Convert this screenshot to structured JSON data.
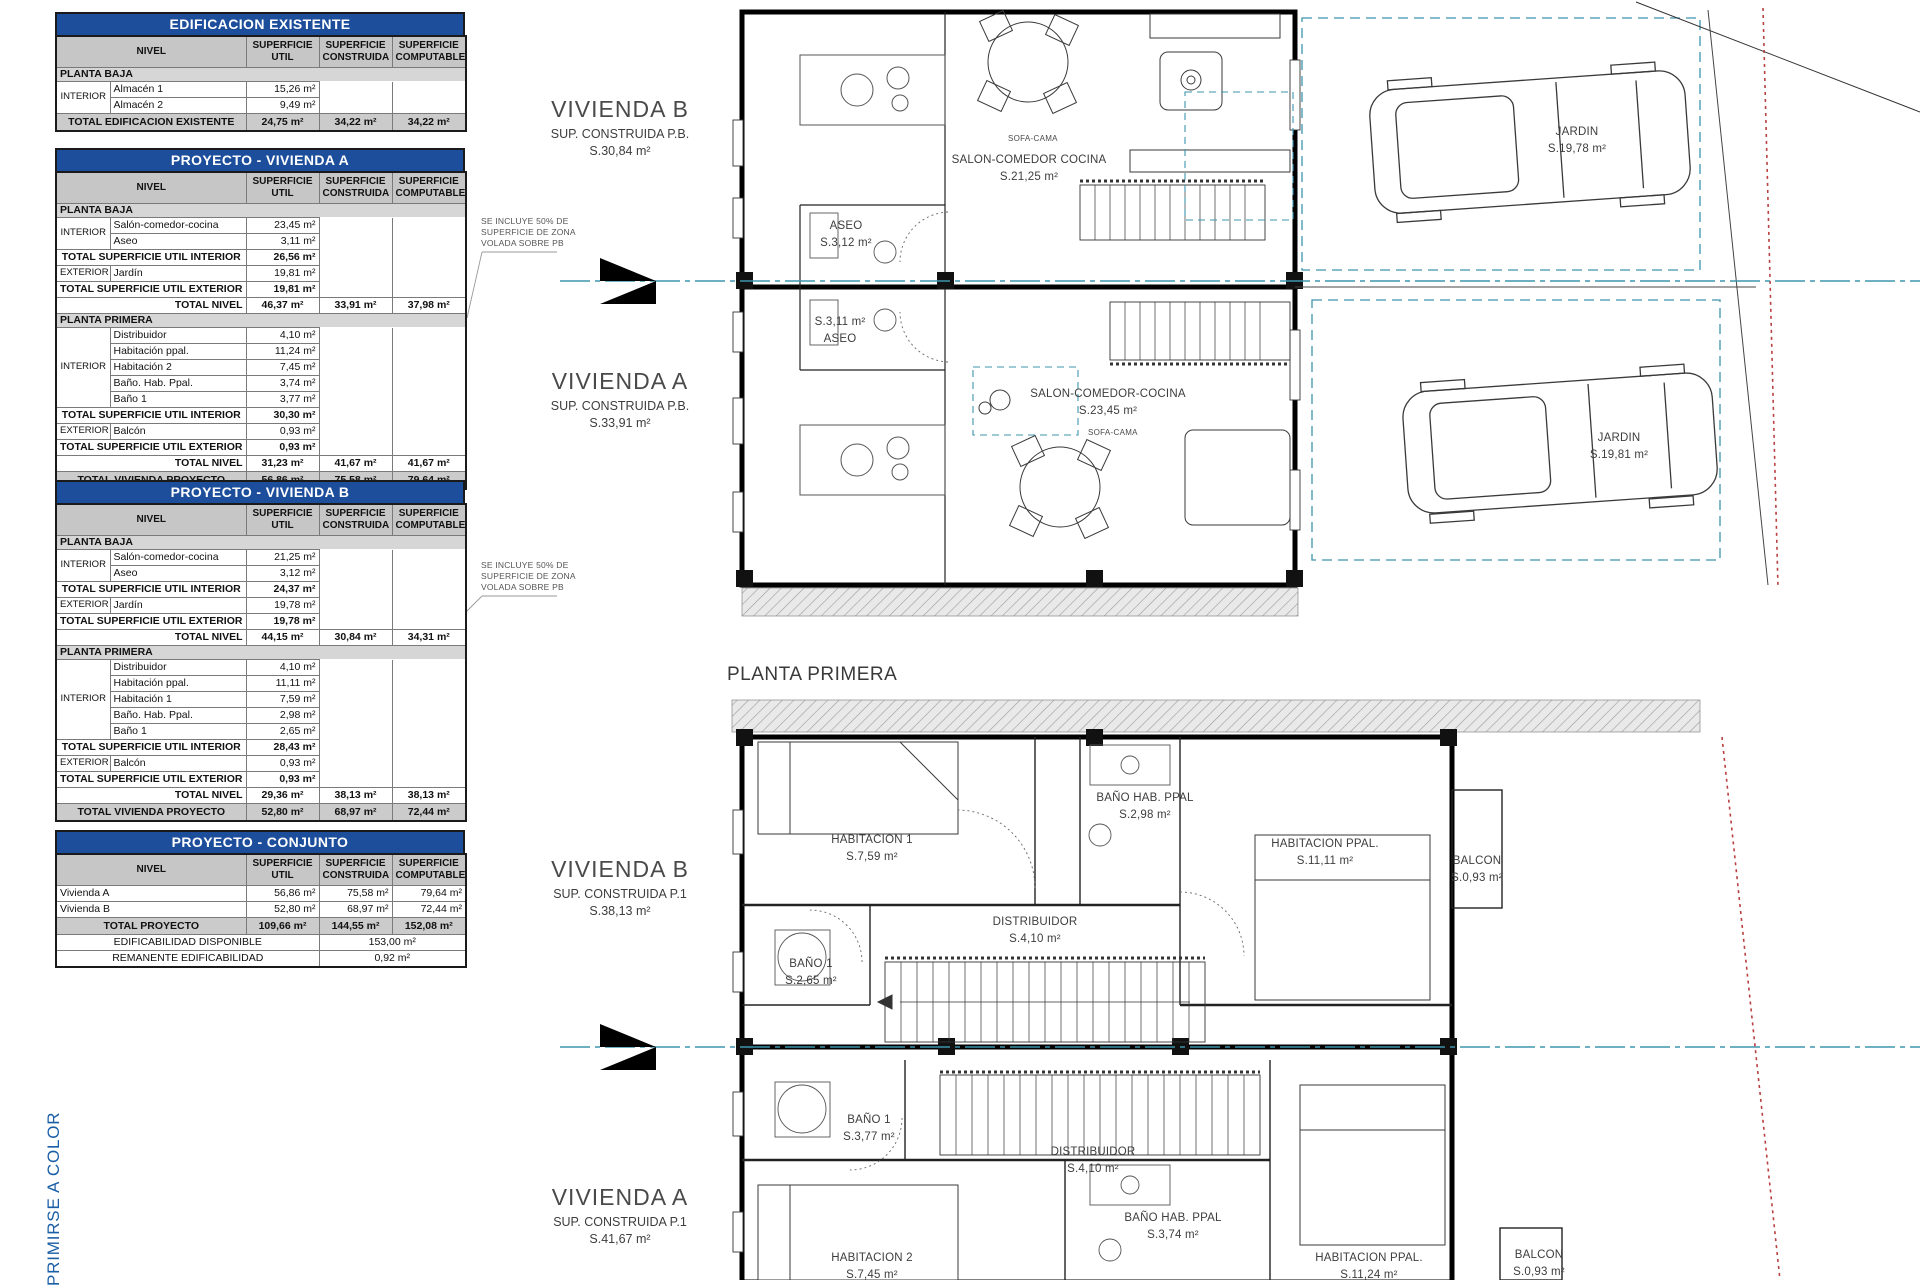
{
  "table_headers": {
    "nivel": "NIVEL",
    "util": "SUPERFICIE\nUTIL",
    "cons": "SUPERFICIE\nCONSTRUIDA",
    "comp": "SUPERFICIE\nCOMPUTABLE"
  },
  "tables": [
    {
      "title": "EDIFICACION EXISTENTE",
      "rows": [
        {
          "t": "sec",
          "label": "PLANTA BAJA"
        },
        {
          "t": "item",
          "group": "INTERIOR",
          "gspan": 2,
          "name": "Almacén 1",
          "util": "15,26 m²"
        },
        {
          "t": "item",
          "name": "Almacén 2",
          "util": "9,49 m²"
        },
        {
          "t": "grand",
          "label": "TOTAL EDIFICACION EXISTENTE",
          "util": "24,75 m²",
          "cons": "34,22 m²",
          "comp": "34,22 m²"
        }
      ]
    },
    {
      "title": "PROYECTO - VIVIENDA A",
      "rows": [
        {
          "t": "sec",
          "label": "PLANTA BAJA"
        },
        {
          "t": "item",
          "group": "INTERIOR",
          "gspan": 2,
          "name": "Salón-comedor-cocina",
          "util": "23,45 m²"
        },
        {
          "t": "item",
          "name": "Aseo",
          "util": "3,11 m²"
        },
        {
          "t": "sub",
          "label": "TOTAL SUPERFICIE UTIL INTERIOR",
          "util": "26,56 m²"
        },
        {
          "t": "item",
          "group": "EXTERIOR",
          "gspan": 1,
          "name": "Jardín",
          "util": "19,81 m²"
        },
        {
          "t": "sub",
          "label": "TOTAL SUPERFICIE UTIL EXTERIOR",
          "util": "19,81 m²"
        },
        {
          "t": "niv",
          "label": "TOTAL NIVEL",
          "util": "46,37 m²",
          "cons": "33,91 m²",
          "comp": "37,98 m²"
        },
        {
          "t": "sec",
          "label": "PLANTA PRIMERA"
        },
        {
          "t": "item",
          "group": "INTERIOR",
          "gspan": 5,
          "name": "Distribuidor",
          "util": "4,10 m²"
        },
        {
          "t": "item",
          "name": "Habitación ppal.",
          "util": "11,24 m²"
        },
        {
          "t": "item",
          "name": "Habitación 2",
          "util": "7,45 m²"
        },
        {
          "t": "item",
          "name": "Baño. Hab. Ppal.",
          "util": "3,74 m²"
        },
        {
          "t": "item",
          "name": "Baño 1",
          "util": "3,77 m²"
        },
        {
          "t": "sub",
          "label": "TOTAL SUPERFICIE UTIL INTERIOR",
          "util": "30,30 m²"
        },
        {
          "t": "item",
          "group": "EXTERIOR",
          "gspan": 1,
          "name": "Balcón",
          "util": "0,93 m²"
        },
        {
          "t": "sub",
          "label": "TOTAL SUPERFICIE UTIL EXTERIOR",
          "util": "0,93 m²"
        },
        {
          "t": "niv",
          "label": "TOTAL NIVEL",
          "util": "31,23 m²",
          "cons": "41,67 m²",
          "comp": "41,67 m²"
        },
        {
          "t": "grand",
          "label": "TOTAL VIVIENDA PROYECTO",
          "util": "56,86 m²",
          "cons": "75,58 m²",
          "comp": "79,64 m²"
        }
      ]
    },
    {
      "title": "PROYECTO - VIVIENDA B",
      "rows": [
        {
          "t": "sec",
          "label": "PLANTA BAJA"
        },
        {
          "t": "item",
          "group": "INTERIOR",
          "gspan": 2,
          "name": "Salón-comedor-cocina",
          "util": "21,25 m²"
        },
        {
          "t": "item",
          "name": "Aseo",
          "util": "3,12 m²"
        },
        {
          "t": "sub",
          "label": "TOTAL SUPERFICIE UTIL INTERIOR",
          "util": "24,37 m²"
        },
        {
          "t": "item",
          "group": "EXTERIOR",
          "gspan": 1,
          "name": "Jardín",
          "util": "19,78 m²"
        },
        {
          "t": "sub",
          "label": "TOTAL SUPERFICIE UTIL EXTERIOR",
          "util": "19,78 m²"
        },
        {
          "t": "niv",
          "label": "TOTAL NIVEL",
          "util": "44,15 m²",
          "cons": "30,84 m²",
          "comp": "34,31 m²"
        },
        {
          "t": "sec",
          "label": "PLANTA PRIMERA"
        },
        {
          "t": "item",
          "group": "INTERIOR",
          "gspan": 5,
          "name": "Distribuidor",
          "util": "4,10 m²"
        },
        {
          "t": "item",
          "name": "Habitación ppal.",
          "util": "11,11 m²"
        },
        {
          "t": "item",
          "name": "Habitación 1",
          "util": "7,59 m²"
        },
        {
          "t": "item",
          "name": "Baño. Hab. Ppal.",
          "util": "2,98 m²"
        },
        {
          "t": "item",
          "name": "Baño 1",
          "util": "2,65 m²"
        },
        {
          "t": "sub",
          "label": "TOTAL SUPERFICIE UTIL INTERIOR",
          "util": "28,43 m²"
        },
        {
          "t": "item",
          "group": "EXTERIOR",
          "gspan": 1,
          "name": "Balcón",
          "util": "0,93 m²"
        },
        {
          "t": "sub",
          "label": "TOTAL SUPERFICIE UTIL EXTERIOR",
          "util": "0,93 m²"
        },
        {
          "t": "niv",
          "label": "TOTAL NIVEL",
          "util": "29,36 m²",
          "cons": "38,13 m²",
          "comp": "38,13 m²"
        },
        {
          "t": "grand",
          "label": "TOTAL VIVIENDA PROYECTO",
          "util": "52,80 m²",
          "cons": "68,97 m²",
          "comp": "72,44 m²"
        }
      ]
    },
    {
      "title": "PROYECTO - CONJUNTO",
      "rows": [
        {
          "t": "plain",
          "name": "Vivienda A",
          "util": "56,86 m²",
          "cons": "75,58 m²",
          "comp": "79,64 m²"
        },
        {
          "t": "plain",
          "name": "Vivienda B",
          "util": "52,80 m²",
          "cons": "68,97 m²",
          "comp": "72,44 m²"
        },
        {
          "t": "grand",
          "label": "TOTAL PROYECTO",
          "util": "109,66 m²",
          "cons": "144,55 m²",
          "comp": "152,08 m²"
        },
        {
          "t": "span",
          "label": "EDIFICABILIDAD DISPONIBLE",
          "value": "153,00 m²"
        },
        {
          "t": "span",
          "label": "REMANENTE EDIFICABILIDAD",
          "value": "0,92 m²"
        }
      ]
    }
  ],
  "annotations": {
    "lines": [
      "SE INCLUYE 50% DE",
      "SUPERFICIE DE ZONA",
      "VOLADA SOBRE PB"
    ]
  },
  "plans": {
    "heading": "PLANTA PRIMERA",
    "upper": {
      "vivienda_b": {
        "name": "VIVIENDA B",
        "sub1": "SUP. CONSTRUIDA P.B.",
        "sub2": "S.30,84  m²"
      },
      "vivienda_a": {
        "name": "VIVIENDA A",
        "sub1": "SUP. CONSTRUIDA P.B.",
        "sub2": "S.33,91  m²"
      },
      "rooms": {
        "salon_b": {
          "l1": "SALON-COMEDOR COCINA",
          "l2": "S.21,25  m²"
        },
        "salon_a": {
          "l1": "SALON-COMEDOR-COCINA",
          "l2": "S.23,45  m²"
        },
        "aseo_b": {
          "l1": "ASEO",
          "l2": "S.3,12  m²"
        },
        "aseo_a": {
          "l1": "S.3,11  m²",
          "l2": "ASEO"
        },
        "jardin_b": {
          "l1": "JARDIN",
          "l2": "S.19,78  m²"
        },
        "jardin_a": {
          "l1": "JARDIN",
          "l2": "S.19,81  m²"
        },
        "sofa_b": "SOFA-CAMA",
        "sofa_a": "SOFA-CAMA"
      }
    },
    "lower": {
      "vivienda_b": {
        "name": "VIVIENDA B",
        "sub1": "SUP. CONSTRUIDA P.1",
        "sub2": "S.38,13  m²"
      },
      "vivienda_a": {
        "name": "VIVIENDA A",
        "sub1": "SUP. CONSTRUIDA P.1",
        "sub2": "S.41,67  m²"
      },
      "rooms": {
        "hab1_b": {
          "l1": "HABITACION 1",
          "l2": "S.7,59  m²"
        },
        "banyo_ppal_b": {
          "l1": "BAÑO HAB. PPAL",
          "l2": "S.2,98  m²"
        },
        "hab_ppal_b": {
          "l1": "HABITACION PPAL.",
          "l2": "S.11,11  m²"
        },
        "balcon_b": {
          "l1": "BALCON",
          "l2": "S.0,93  m²"
        },
        "distrib_b": {
          "l1": "DISTRIBUIDOR",
          "l2": "S.4,10  m²"
        },
        "banyo1_b": {
          "l1": "BAÑO 1",
          "l2": "S.2,65  m²"
        },
        "banyo1_a": {
          "l1": "BAÑO 1",
          "l2": "S.3,77  m²"
        },
        "distrib_a": {
          "l1": "DISTRIBUIDOR",
          "l2": "S.4,10  m²"
        },
        "hab2_a": {
          "l1": "HABITACION 2",
          "l2": "S.7,45  m²"
        },
        "banyo_ppal_a": {
          "l1": "BAÑO HAB. PPAL",
          "l2": "S.3,74  m²"
        },
        "hab_ppal_a": {
          "l1": "HABITACION PPAL.",
          "l2": "S.11,24  m²"
        },
        "balcon_a": {
          "l1": "BALCON",
          "l2": "S.0,93  m²"
        }
      }
    }
  },
  "side_text": "PRIMIRSE A COLOR",
  "colors": {
    "table_title_bg": "#1d4e9c",
    "header_gray": "#c6c6c6",
    "section_gray": "#d6d6d6",
    "wall_black": "#000000",
    "property_teal": "#3d95ad",
    "boundary_red": "#b84040",
    "margin_blue": "#1a5ea6"
  }
}
